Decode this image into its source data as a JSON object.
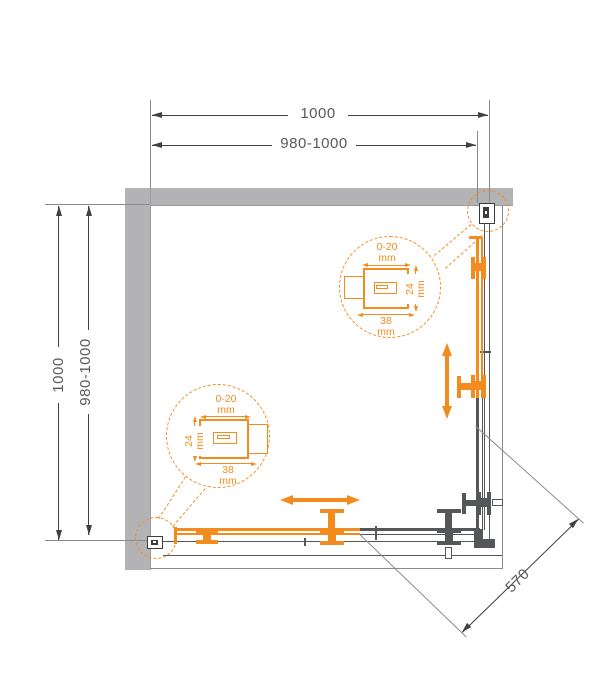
{
  "colors": {
    "accent_orange": "#F28C1E",
    "wall_gray": "#b3b3b5",
    "frame_line": "#55565a",
    "dimension_text": "#58595b"
  },
  "dimensions": {
    "top_outer": "1000",
    "top_inner": "980-1000",
    "left_outer": "1000",
    "left_inner": "980-1000",
    "diagonal_opening": "570"
  },
  "callout_upper": {
    "adjust": "0-20",
    "adjust_unit": "mm",
    "depth": "24",
    "depth_unit": "mm",
    "width": "38",
    "width_unit": "mm"
  },
  "callout_lower": {
    "adjust": "0-20",
    "adjust_unit": "mm",
    "depth": "24",
    "depth_unit": "mm",
    "width": "38",
    "width_unit": "mm"
  }
}
